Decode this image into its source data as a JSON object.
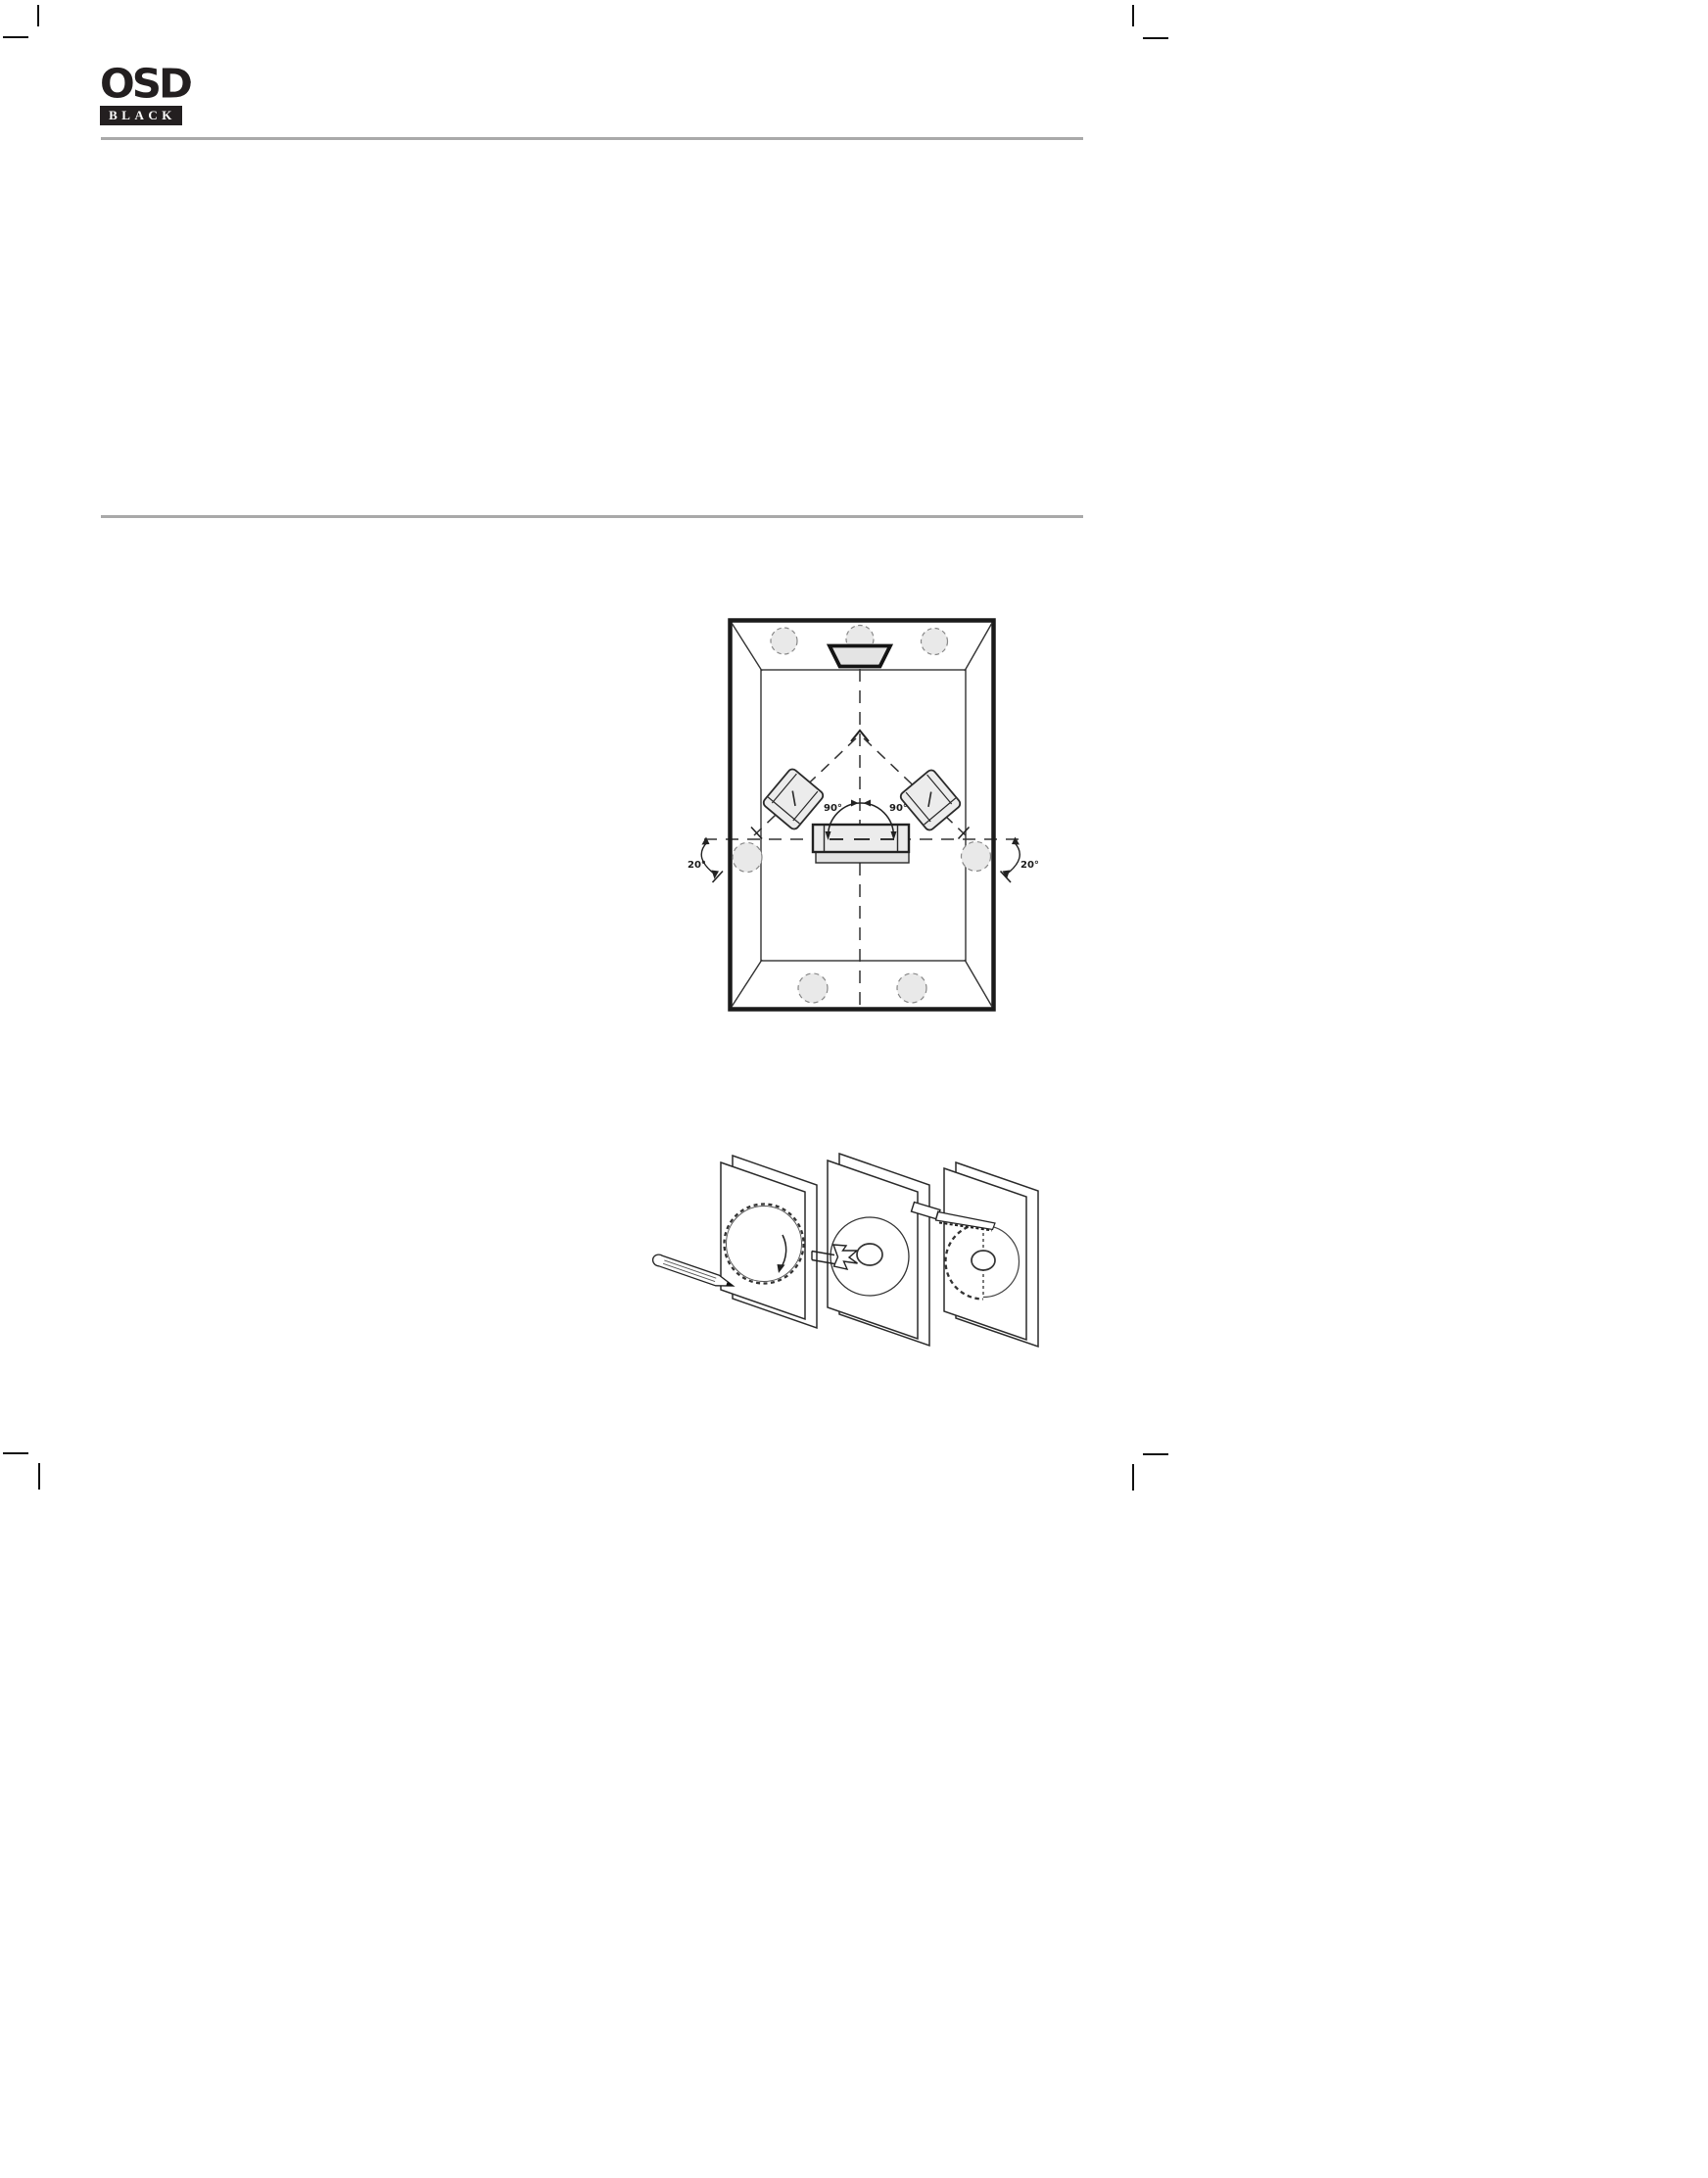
{
  "logo": {
    "brand": "OSD",
    "registered_mark": "®",
    "series": "BLACK"
  },
  "room_diagram": {
    "label_90_left": "90°",
    "label_90_right": "90°",
    "label_20_left": "20°",
    "label_20_right": "20°",
    "elements": [
      "front-ceiling-speakers",
      "tv-screen",
      "listening-armchairs",
      "couch",
      "side-surround-speakers",
      "rear-surround-speakers",
      "listening-triangle-dashed-lines"
    ]
  },
  "install_diagram": {
    "steps": [
      "trace-cutout-circle-with-pencil",
      "drill-center-pilot-hole",
      "cut-opening-with-drywall-saw"
    ]
  },
  "colors": {
    "rule_gray": "#a9a9a9",
    "ink": "#1a1a1a",
    "fill_gray": "#ececec"
  }
}
